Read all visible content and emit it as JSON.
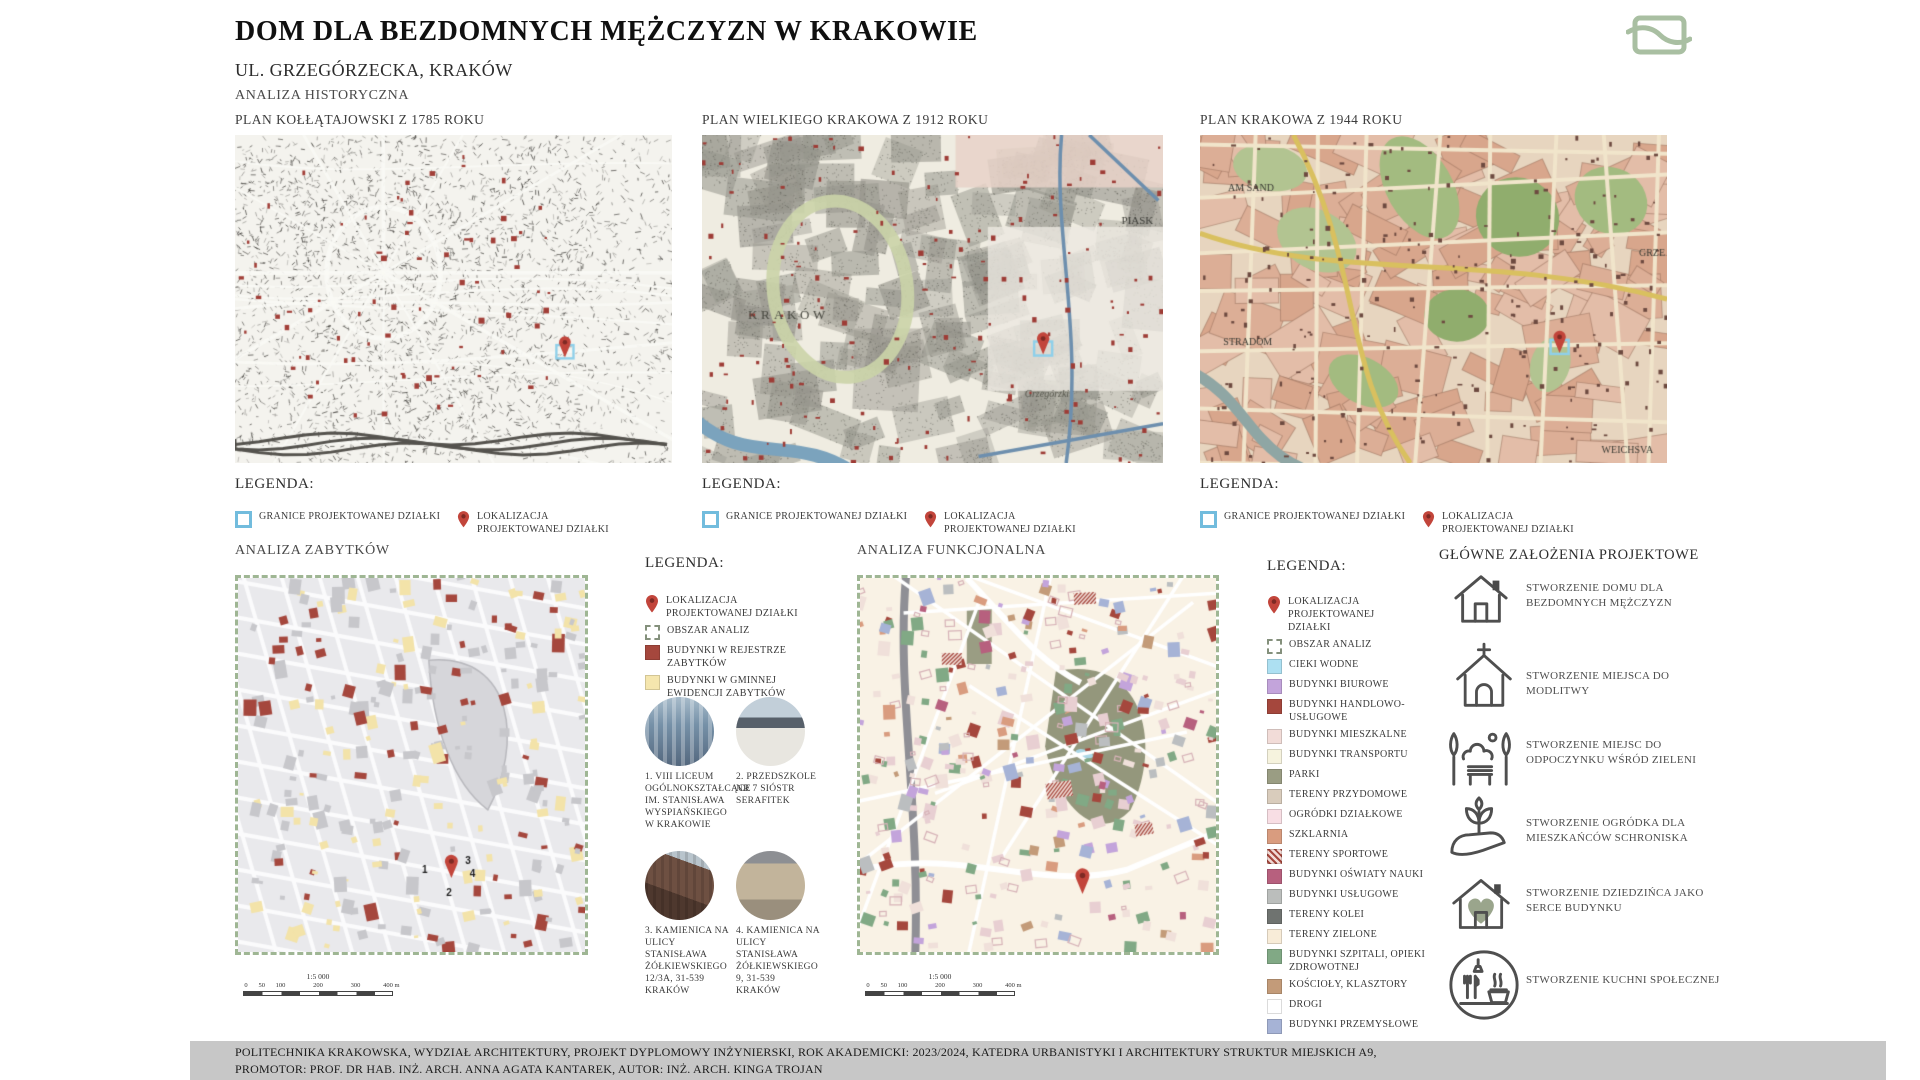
{
  "header": {
    "title": "DOM DLA BEZDOMNYCH MĘŻCZYZN W KRAKOWIE",
    "subtitle": "UL. GRZEGÓRZECKA, KRAKÓW",
    "section_label": "ANALIZA HISTORYCZNA"
  },
  "colors": {
    "accent_sage": "#A9BFA2",
    "pin_red": "#C2453B",
    "boundary_blue": "#72BCDD",
    "monument_red": "#A5473D",
    "evidence_yellow": "#F5E6AE"
  },
  "historical_maps": [
    {
      "title": "PLAN KOŁŁĄTAJOWSKI Z 1785 ROKU",
      "legend_title": "LEGENDA:",
      "legend": [
        {
          "icon": "boundary-square-icon",
          "label": "GRANICE PROJEKTOWANEJ DZIAŁKI"
        },
        {
          "icon": "location-pin-icon",
          "label": "LOKALIZACJA PROJEKTOWANEJ DZIAŁKI"
        }
      ]
    },
    {
      "title": "PLAN WIELKIEGO KRAKOWA Z 1912 ROKU",
      "legend_title": "LEGENDA:",
      "legend": [
        {
          "icon": "boundary-square-icon",
          "label": "GRANICE PROJEKTOWANEJ DZIAŁKI"
        },
        {
          "icon": "location-pin-icon",
          "label": "LOKALIZACJA PROJEKTOWANEJ DZIAŁKI"
        }
      ]
    },
    {
      "title": "PLAN  KRAKOWA Z 1944 ROKU",
      "legend_title": "LEGENDA:",
      "legend": [
        {
          "icon": "boundary-square-icon",
          "label": "GRANICE PROJEKTOWANEJ DZIAŁKI"
        },
        {
          "icon": "location-pin-icon",
          "label": "LOKALIZACJA PROJEKTOWANEJ DZIAŁKI"
        }
      ]
    }
  ],
  "zabytki": {
    "heading": "ANALIZA ZABYTKÓW",
    "legend_title": "LEGENDA:",
    "legend": [
      {
        "icon": "location-pin-icon",
        "label": "LOKALIZACJA PROJEKTOWANEJ DZIAŁKI"
      },
      {
        "icon": "analysis-area-icon",
        "label": "OBSZAR ANALIZ"
      },
      {
        "color": "#A5473D",
        "label": "BUDYNKI W REJESTRZE ZABYTKÓW"
      },
      {
        "color": "#F5E6AE",
        "label": "BUDYNKI W GMINNEJ EWIDENCJI ZABYTKÓW"
      }
    ],
    "photos": [
      {
        "caption": "1. VIII LICEUM OGÓLNOKSZTAŁCĄCE IM. STANISŁAWA WYSPIAŃSKIEGO W KRAKOWIE"
      },
      {
        "caption": "2. PRZEDSZKOLE NR 7 SIÓSTR SERAFITEK"
      },
      {
        "caption": "3. KAMIENICA NA ULICY STANISŁAWA ŻÓŁKIEWSKIEGO 12/3A, 31-539 KRAKÓW"
      },
      {
        "caption": "4. KAMIENICA NA ULICY STANISŁAWA ŻÓŁKIEWSKIEGO 9, 31-539 KRAKÓW"
      }
    ],
    "scale": {
      "ratio": "1:5 000",
      "ticks": [
        "0",
        "50",
        "100",
        "200",
        "300",
        "400 m"
      ]
    }
  },
  "funkcjonalna": {
    "heading": "ANALIZA FUNKCJONALNA",
    "legend_title": "LEGENDA:",
    "legend": [
      {
        "icon": "location-pin-icon",
        "label": "LOKALIZACJA PROJEKTOWANEJ DZIAŁKI"
      },
      {
        "icon": "analysis-area-icon",
        "label": "OBSZAR ANALIZ"
      },
      {
        "color": "#ADE0F2",
        "label": "CIEKI WODNE"
      },
      {
        "color": "#C3A4DB",
        "label": "BUDYNKI BIUROWE"
      },
      {
        "color": "#A5473D",
        "label": "BUDYNKI HANDLOWO-USŁUGOWE"
      },
      {
        "color": "#F2DCD8",
        "label": "BUDYNKI MIESZKALNE"
      },
      {
        "color": "#F6F3DE",
        "label": "BUDYNKI TRANSPORTU"
      },
      {
        "color": "#9A9D83",
        "label": "PARKI"
      },
      {
        "color": "#D9CCBC",
        "label": "TERENY PRZYDOMOWE"
      },
      {
        "color": "#F8DEE4",
        "label": "OGRÓDKI DZIAŁKOWE"
      },
      {
        "color": "#D99C7F",
        "label": "SZKLARNIA"
      },
      {
        "pattern": "red-hatch",
        "label": "TERENY SPORTOWE"
      },
      {
        "color": "#B7607E",
        "label": "BUDYNKI OŚWIATY NAUKI"
      },
      {
        "color": "#BBBEBC",
        "label": "BUDYNKI USŁUGOWE"
      },
      {
        "color": "#6F7370",
        "label": "TERENY KOLEI"
      },
      {
        "color": "#F8ECD8",
        "label": "TERENY ZIELONE"
      },
      {
        "color": "#81A985",
        "label": "BUDYNKI SZPITALI, OPIEKI ZDROWOTNEJ"
      },
      {
        "color": "#C39B79",
        "label": "KOŚCIOŁY, KLASZTORY"
      },
      {
        "color": "#FFFFFF",
        "label": "DROGI"
      },
      {
        "color": "#A6B3D6",
        "label": "BUDYNKI PRZEMYSŁOWE"
      }
    ],
    "scale": {
      "ratio": "1:5 000",
      "ticks": [
        "0",
        "50",
        "100",
        "200",
        "300",
        "400 m"
      ]
    }
  },
  "zalozenia": {
    "heading": "GŁÓWNE ZAŁOŻENIA PROJEKTOWE",
    "items": [
      {
        "icon": "house-icon",
        "label": "STWORZENIE DOMU DLA BEZDOMNYCH MĘŻCZYZN"
      },
      {
        "icon": "church-icon",
        "label": "STWORZENIE MIEJSCA DO MODLITWY"
      },
      {
        "icon": "green-rest-icon",
        "label": "STWORZENIE MIEJSC DO ODPOCZYNKU WŚRÓD ZIELENI"
      },
      {
        "icon": "hand-plant-icon",
        "label": "STWORZENIE OGRÓDKA DLA MIESZKAŃCÓW SCHRONISKA"
      },
      {
        "icon": "house-heart-icon",
        "label": "STWORZENIE DZIEDZIŃCA JAKO SERCE BUDYNKU"
      },
      {
        "icon": "community-kitchen-icon",
        "label": "STWORZENIE KUCHNI SPOŁECZNEJ"
      }
    ]
  },
  "footer": {
    "line1": "POLITECHNIKA KRAKOWSKA,  WYDZIAŁ ARCHITEKTURY, PROJEKT DYPLOMOWY INŻYNIERSKI, ROK AKADEMICKI: 2023/2024, KATEDRA URBANISTYKI I ARCHITEKTURY STRUKTUR MIEJSKICH A9,",
    "line2": "PROMOTOR: PROF. DR HAB. INŻ. ARCH. ANNA AGATA KANTAREK,  AUTOR: INŻ. ARCH. KINGA TROJAN"
  }
}
